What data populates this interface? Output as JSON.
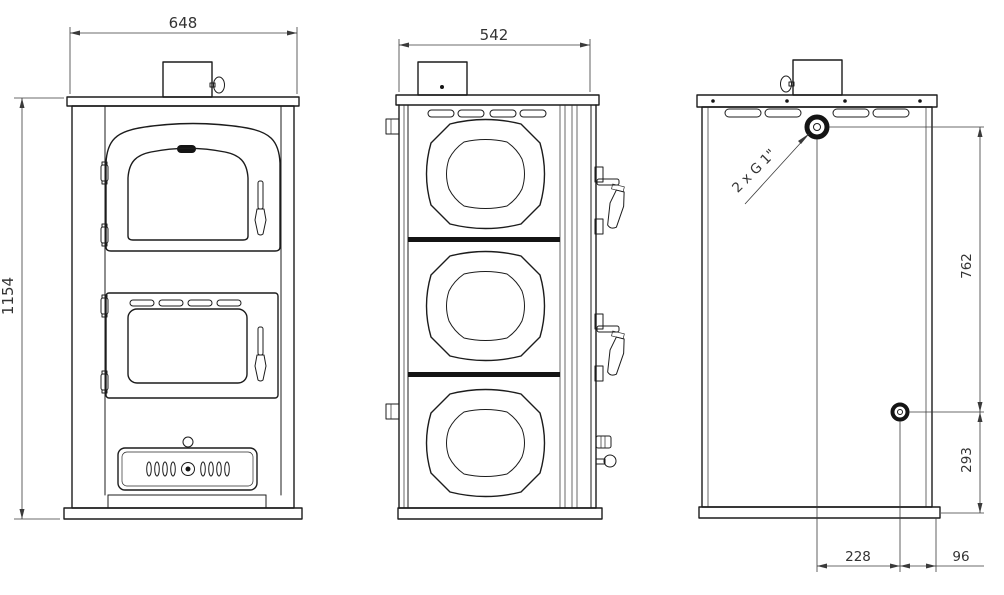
{
  "dimensions": {
    "width_front": "648",
    "depth_side": "542",
    "height_total": "1154",
    "outlet_span": "762",
    "outlet_bottom": "293",
    "outlet_offset_center": "228",
    "outlet_offset_edge": "96"
  },
  "annotations": {
    "thread_note": "2 x G 1\""
  }
}
